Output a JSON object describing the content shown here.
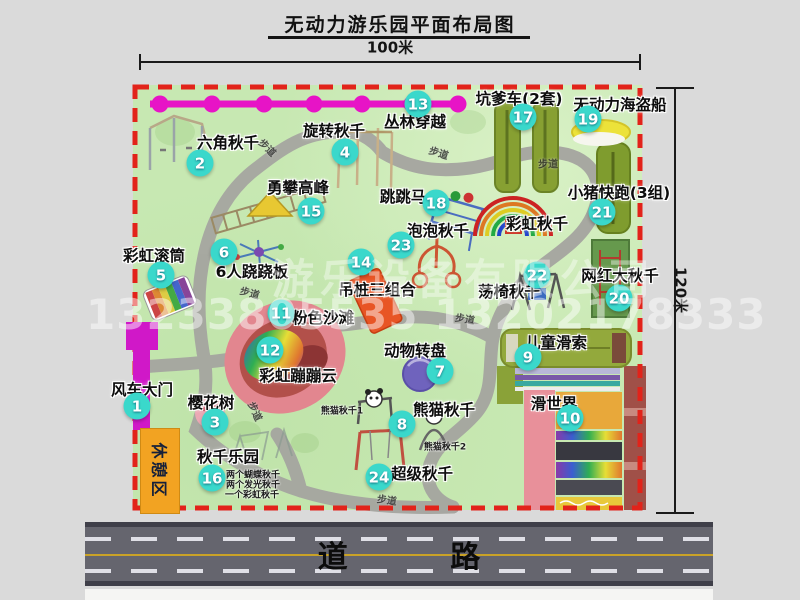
{
  "title": "无动力游乐园平面布局图",
  "dimensions": {
    "width_label": "100米",
    "height_label": "120米"
  },
  "road": {
    "label": "道 路"
  },
  "watermark": {
    "line1": "游乐设备有限公司",
    "line2": "13233805535 13202178333"
  },
  "rest_area": {
    "label": "休憩区"
  },
  "walkway_label": "步道",
  "colors": {
    "map-green": "#c7e8b2",
    "path-gray": "#a5a5a0",
    "border-red": "#e2231a",
    "chain-magenta": "#e714c6",
    "badge-cyan": "#3ad8cb",
    "gate-magenta": "#d018c8",
    "rest-orange": "#f2a322",
    "road-gray": "#65656e"
  },
  "attractions": [
    {
      "num": "1",
      "label": "风车大门",
      "badge": [
        137,
        406
      ],
      "label_pos": [
        142,
        389
      ]
    },
    {
      "num": "2",
      "label": "六角秋千",
      "badge": [
        200,
        163
      ],
      "label_pos": [
        228,
        142
      ]
    },
    {
      "num": "3",
      "label": "樱花树",
      "badge": [
        215,
        422
      ],
      "label_pos": [
        211,
        402
      ]
    },
    {
      "num": "4",
      "label": "旋转秋千",
      "badge": [
        345,
        152
      ],
      "label_pos": [
        334,
        130
      ]
    },
    {
      "num": "5",
      "label": "彩虹滚筒",
      "badge": [
        161,
        275
      ],
      "label_pos": [
        154,
        255
      ]
    },
    {
      "num": "6",
      "label": "6人跷跷板",
      "badge": [
        224,
        252
      ],
      "label_pos": [
        252,
        271
      ]
    },
    {
      "num": "7",
      "label": "动物转盘",
      "badge": [
        440,
        371
      ],
      "label_pos": [
        415,
        350
      ]
    },
    {
      "num": "8",
      "label": "熊猫秋千",
      "badge": [
        402,
        424
      ],
      "label_pos": [
        444,
        409
      ]
    },
    {
      "num": "9",
      "label": "儿童滑索",
      "badge": [
        528,
        357
      ],
      "label_pos": [
        556,
        342
      ]
    },
    {
      "num": "10",
      "label": "滑世界",
      "badge": [
        570,
        418
      ],
      "label_pos": [
        554,
        403
      ]
    },
    {
      "num": "11",
      "label": "粉色沙滩",
      "badge": [
        281,
        313
      ],
      "label_pos": [
        323,
        317
      ]
    },
    {
      "num": "12",
      "label": "彩虹蹦蹦云",
      "badge": [
        270,
        350
      ],
      "label_pos": [
        298,
        375
      ]
    },
    {
      "num": "13",
      "label": "丛林穿越",
      "badge": [
        418,
        104
      ],
      "label_pos": [
        415,
        121
      ]
    },
    {
      "num": "14",
      "label": "吊桩三组合",
      "badge": [
        361,
        262
      ],
      "label_pos": [
        377,
        289
      ]
    },
    {
      "num": "15",
      "label": "勇攀高峰",
      "badge": [
        311,
        211
      ],
      "label_pos": [
        298,
        187
      ]
    },
    {
      "num": "16",
      "label": "秋千乐园",
      "badge": [
        212,
        478
      ],
      "label_pos": [
        228,
        456
      ]
    },
    {
      "num": "17",
      "label": "坑爹车(2套)",
      "badge": [
        523,
        117
      ],
      "label_pos": [
        519,
        98
      ]
    },
    {
      "num": "18",
      "label": "跳跳马",
      "badge": [
        436,
        203
      ],
      "label_pos": [
        403,
        196
      ]
    },
    {
      "num": "19",
      "label": "无动力海盗船",
      "badge": [
        588,
        119
      ],
      "label_pos": [
        620,
        104
      ]
    },
    {
      "num": "20",
      "label": "网红大秋千",
      "badge": [
        619,
        298
      ],
      "label_pos": [
        620,
        275
      ]
    },
    {
      "num": "21",
      "label": "小猪快跑(3组)",
      "badge": [
        602,
        212
      ],
      "label_pos": [
        619,
        192
      ]
    },
    {
      "num": "22",
      "label": "荡椅秋千",
      "badge": [
        537,
        275
      ],
      "label_pos": [
        509,
        291
      ]
    },
    {
      "num": "23",
      "label": "泡泡秋千",
      "badge": [
        401,
        245
      ],
      "label_pos": [
        438,
        230
      ]
    },
    {
      "num": "24",
      "label": "超级秋千",
      "badge": [
        379,
        477
      ],
      "label_pos": [
        422,
        473
      ]
    },
    {
      "num": null,
      "label": "彩虹秋千",
      "badge": null,
      "label_pos": [
        537,
        223
      ]
    }
  ],
  "walkway_positions": [
    [
      268,
      147,
      45
    ],
    [
      439,
      152,
      18
    ],
    [
      548,
      163,
      0
    ],
    [
      250,
      292,
      15
    ],
    [
      465,
      318,
      10
    ],
    [
      256,
      411,
      65
    ],
    [
      387,
      499,
      8
    ]
  ],
  "sub_labels": [
    {
      "text": "熊猫秋千1",
      "pos": [
        342,
        410
      ]
    },
    {
      "text": "熊猫秋千2",
      "pos": [
        445,
        446
      ]
    },
    {
      "text": "两个蝴蝶秋千",
      "pos": [
        253,
        474
      ]
    },
    {
      "text": "两个发光秋千",
      "pos": [
        253,
        484
      ]
    },
    {
      "text": "一个彩虹秋千",
      "pos": [
        252,
        494
      ]
    }
  ]
}
